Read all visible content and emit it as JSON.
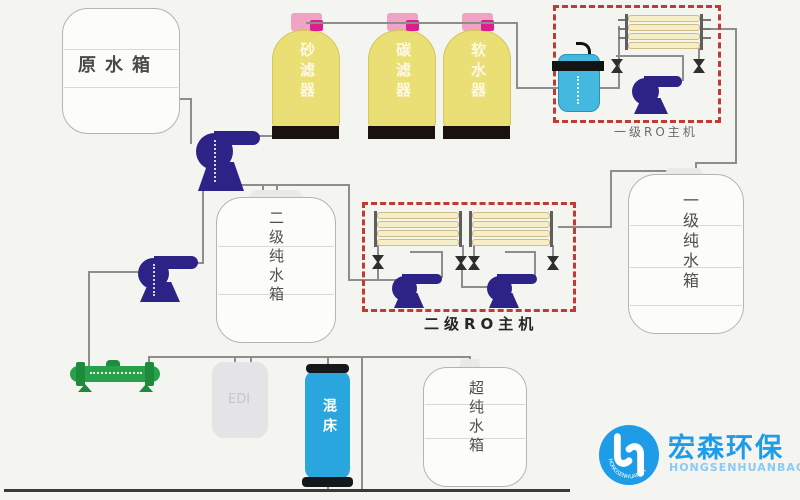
{
  "page": {
    "background": "#f4f4f1"
  },
  "colors": {
    "pipe": "#8d8d8d",
    "dashed_box_red": "#c23a35",
    "vessel_yellow": "#e9df74",
    "pump_navy": "#2d2387",
    "membrane_cream": "#f5eec6",
    "uv_green": "#27a24a",
    "mixed_bed_blue": "#2aa6df",
    "precision_filter_blue": "#45b8e0",
    "cap_pink": "#f0a3c3",
    "valve_magenta": "#dd1f8d",
    "logo_blue": "#1f9ce8"
  },
  "tanks": {
    "raw_water": {
      "label": "原水箱"
    },
    "stage2_pure": {
      "label": "二级纯水箱"
    },
    "stage1_pure": {
      "label": "一级纯水箱"
    },
    "ultra_pure": {
      "label": "超纯水箱"
    },
    "edi": {
      "label": "EDI"
    }
  },
  "pretreatment_filters": [
    {
      "label": "砂滤器"
    },
    {
      "label": "碳滤器"
    },
    {
      "label": "软水器"
    }
  ],
  "ro_units": {
    "stage1": {
      "label": "一级RO主机"
    },
    "stage2": {
      "label": "二级RO主机"
    }
  },
  "polishing": {
    "mixed_bed": {
      "label": "混床"
    }
  },
  "logo": {
    "cn": "宏森环保",
    "en": "HONGSENHUANBAO"
  }
}
